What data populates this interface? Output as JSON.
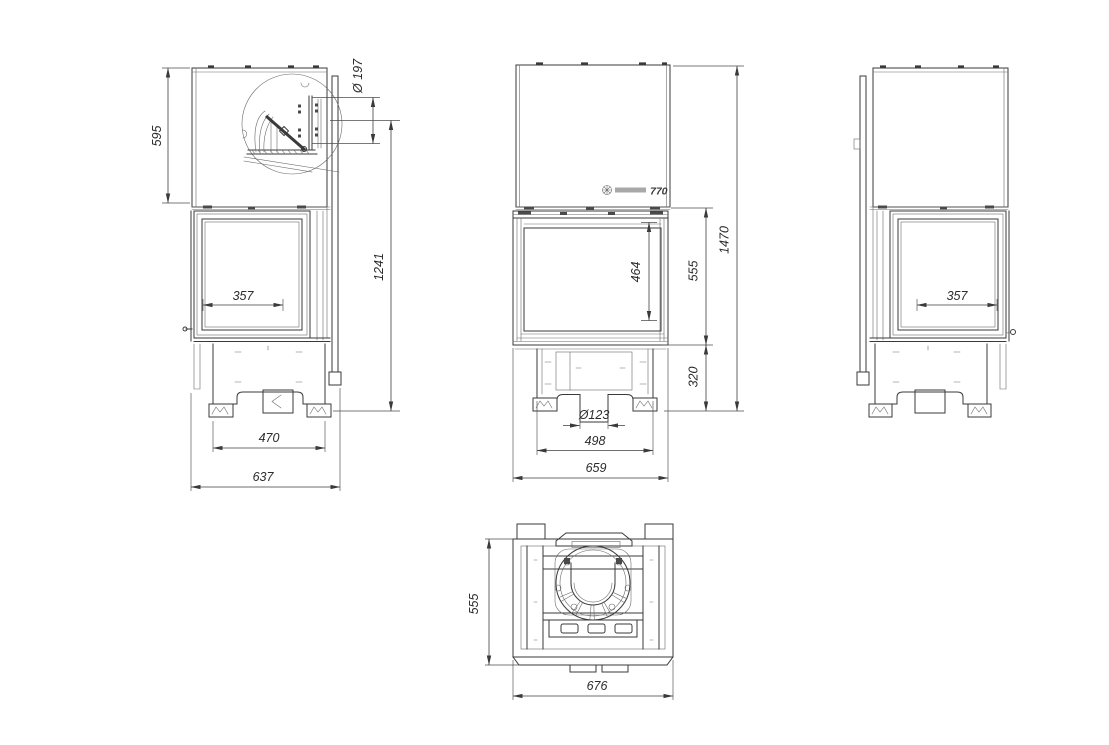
{
  "drawing": {
    "kind": "fireplace insert multi-view technical drawing",
    "background": "#ffffff",
    "line_color": "#3a3a3a"
  },
  "views": {
    "side_left": {
      "label": "left side view",
      "dims": {
        "top_box_height": "595",
        "flue_diameter": "Ø 197",
        "flue_axis_to_floor": "1241",
        "side_glass_width": "357",
        "feet_spacing": "470",
        "total_depth": "637"
      }
    },
    "front": {
      "label": "front view",
      "logo": {
        "model": "770"
      },
      "dims": {
        "glass_height": "464",
        "door_section_height": "555",
        "base_height": "320",
        "total_height": "1470",
        "air_inlet_diameter": "Ø123",
        "feet_spacing": "498",
        "total_width": "659"
      }
    },
    "side_right": {
      "label": "right side view",
      "dims": {
        "side_glass_width": "357"
      }
    },
    "top": {
      "label": "top plan view",
      "dims": {
        "total_depth": "555",
        "total_width": "676"
      }
    }
  }
}
